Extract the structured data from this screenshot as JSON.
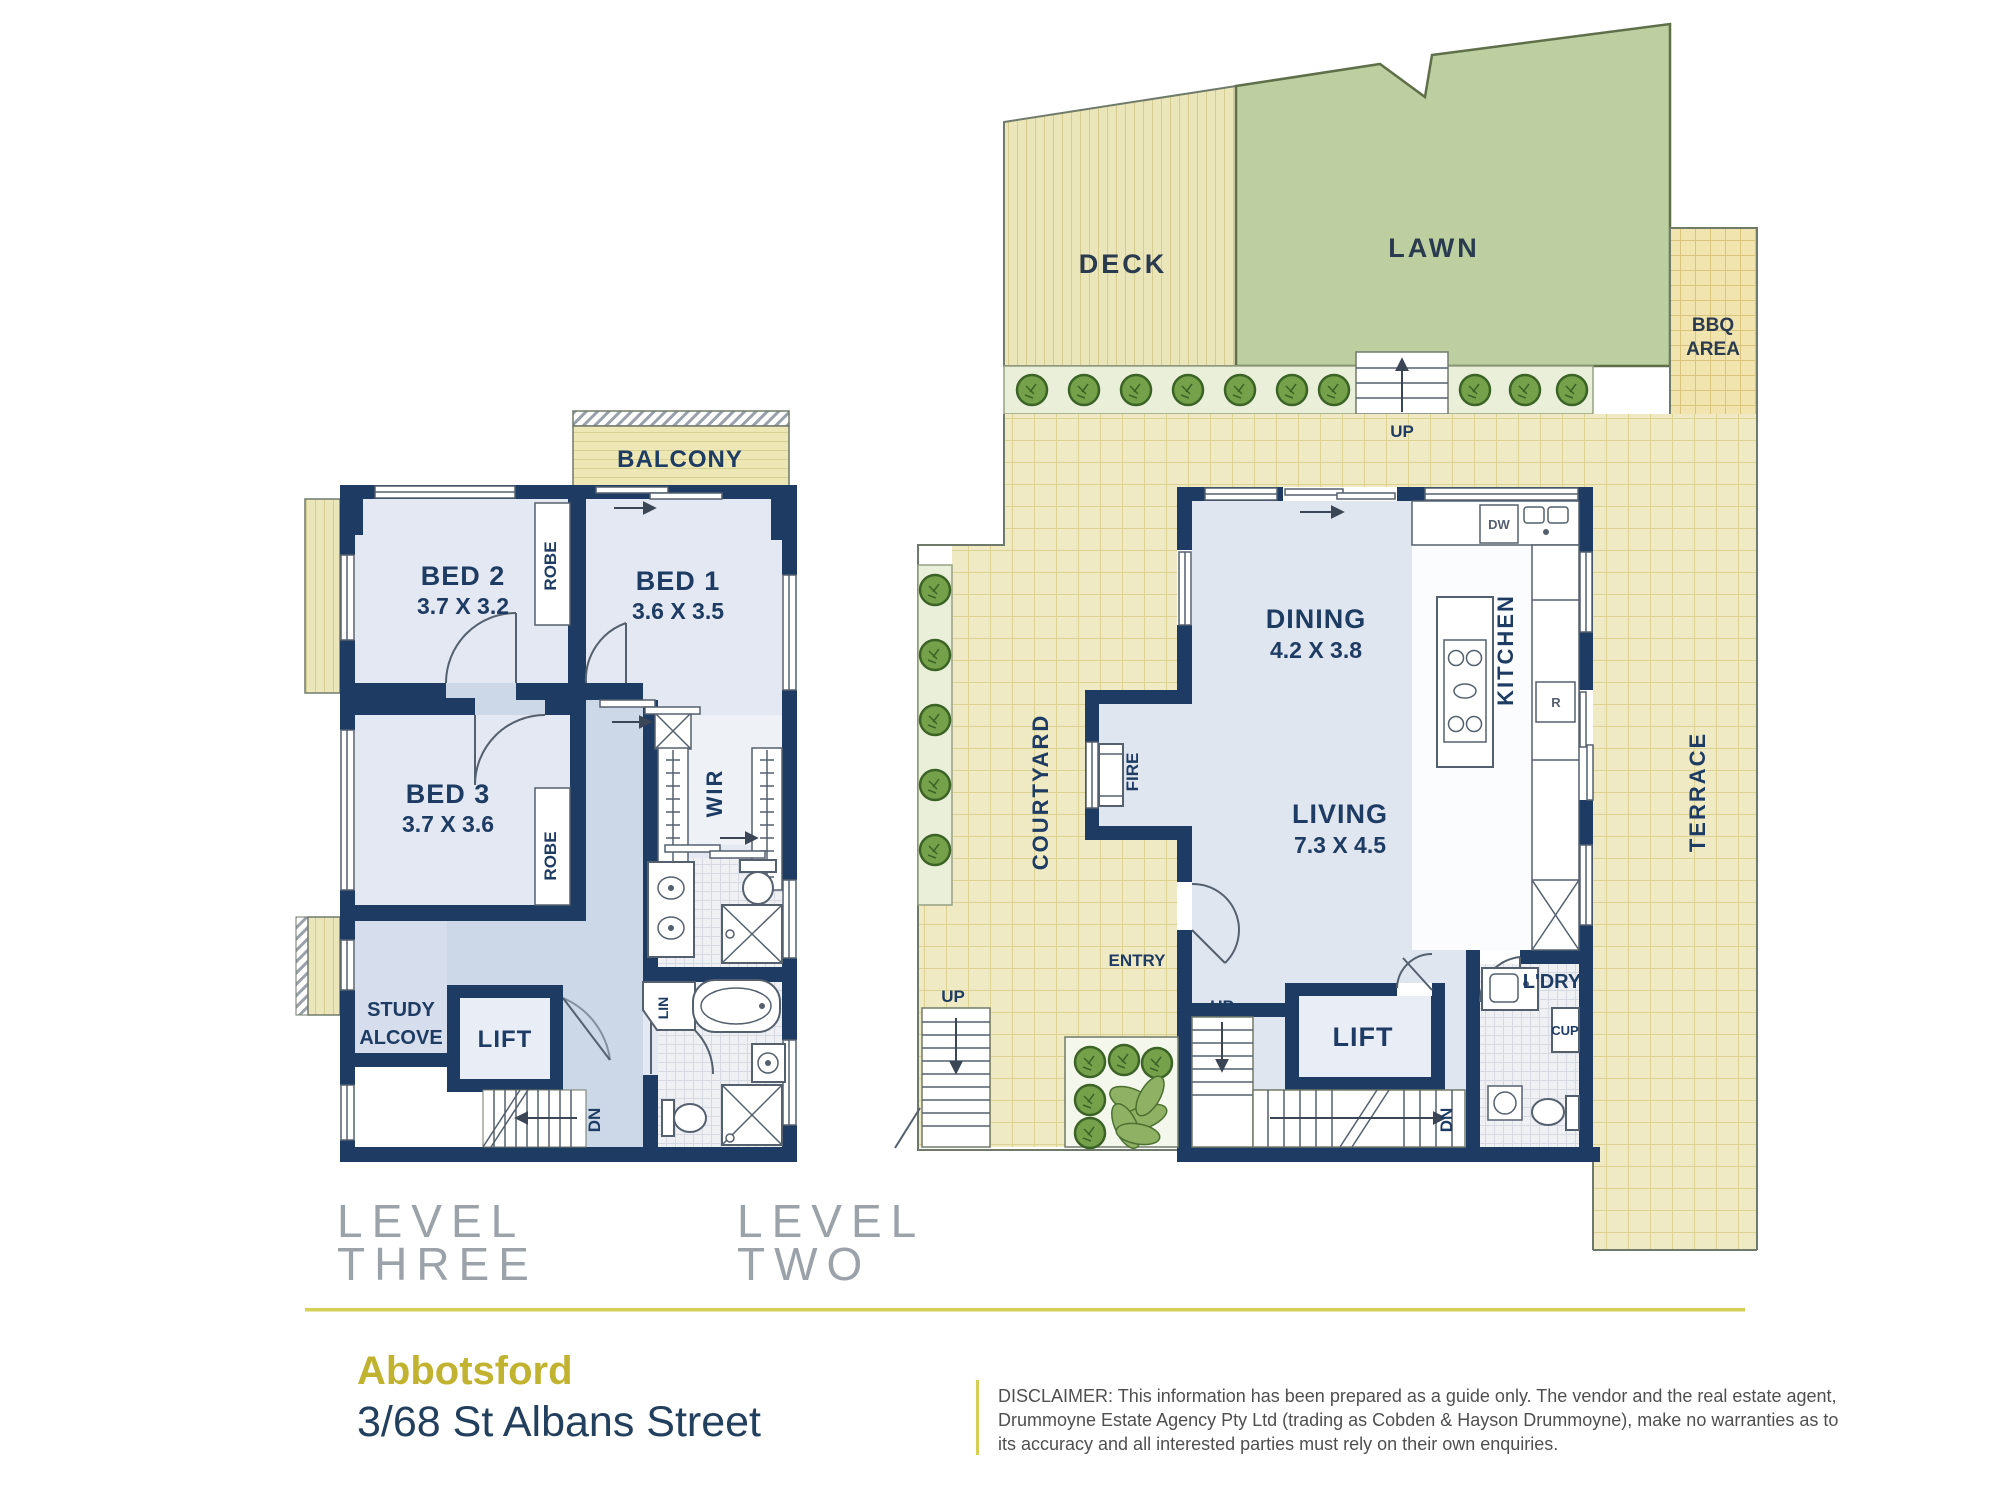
{
  "footer": {
    "suburb": "Abbotsford",
    "address": "3/68 St Albans Street",
    "disclaimer_line1": "DISCLAIMER: This information has been prepared as a guide only. The vendor and the real estate agent,",
    "disclaimer_line2": "Drummoyne Estate Agency Pty Ltd (trading as Cobden & Hayson Drummoyne), make no warranties as to",
    "disclaimer_line3": "its accuracy and all interested parties must rely on their own enquiries."
  },
  "level_three": {
    "title_line1": "LEVEL",
    "title_line2": "THREE",
    "balcony": "BALCONY",
    "bed1": {
      "name": "BED 1",
      "dims": "3.6 X 3.5"
    },
    "bed2": {
      "name": "BED 2",
      "dims": "3.7 X 3.2"
    },
    "bed3": {
      "name": "BED 3",
      "dims": "3.7 X 3.6"
    },
    "robe": "ROBE",
    "wir": "WIR",
    "lin": "LIN",
    "study_line1": "STUDY",
    "study_line2": "ALCOVE",
    "lift": "LIFT",
    "dn": "DN"
  },
  "level_two": {
    "title_line1": "LEVEL",
    "title_line2": "TWO",
    "deck": "DECK",
    "lawn": "LAWN",
    "bbq_line1": "BBQ",
    "bbq_line2": "AREA",
    "up": "UP",
    "courtyard": "COURTYARD",
    "terrace": "TERRACE",
    "kitchen": "KITCHEN",
    "dishwasher": "DW",
    "fridge": "R",
    "dining": {
      "name": "DINING",
      "dims": "4.2 X 3.8"
    },
    "living": {
      "name": "LIVING",
      "dims": "7.3 X 4.5"
    },
    "fire": "FIRE",
    "entry": "ENTRY",
    "lift": "LIFT",
    "dn": "DN",
    "laundry": "L'DRY",
    "cupboard": "CUP"
  },
  "colors": {
    "wall": "#1e3c63",
    "room_fill": "#e3e8f2",
    "hall_fill": "#ccd7e8",
    "outdoor_tile": "#efe9c4",
    "lawn": "#bdcfa0",
    "shrub": "#76a14b",
    "accent_gold": "#c1b22f",
    "title_grey": "#9ca2aa",
    "disclaimer_grey": "#4f4f4f"
  }
}
